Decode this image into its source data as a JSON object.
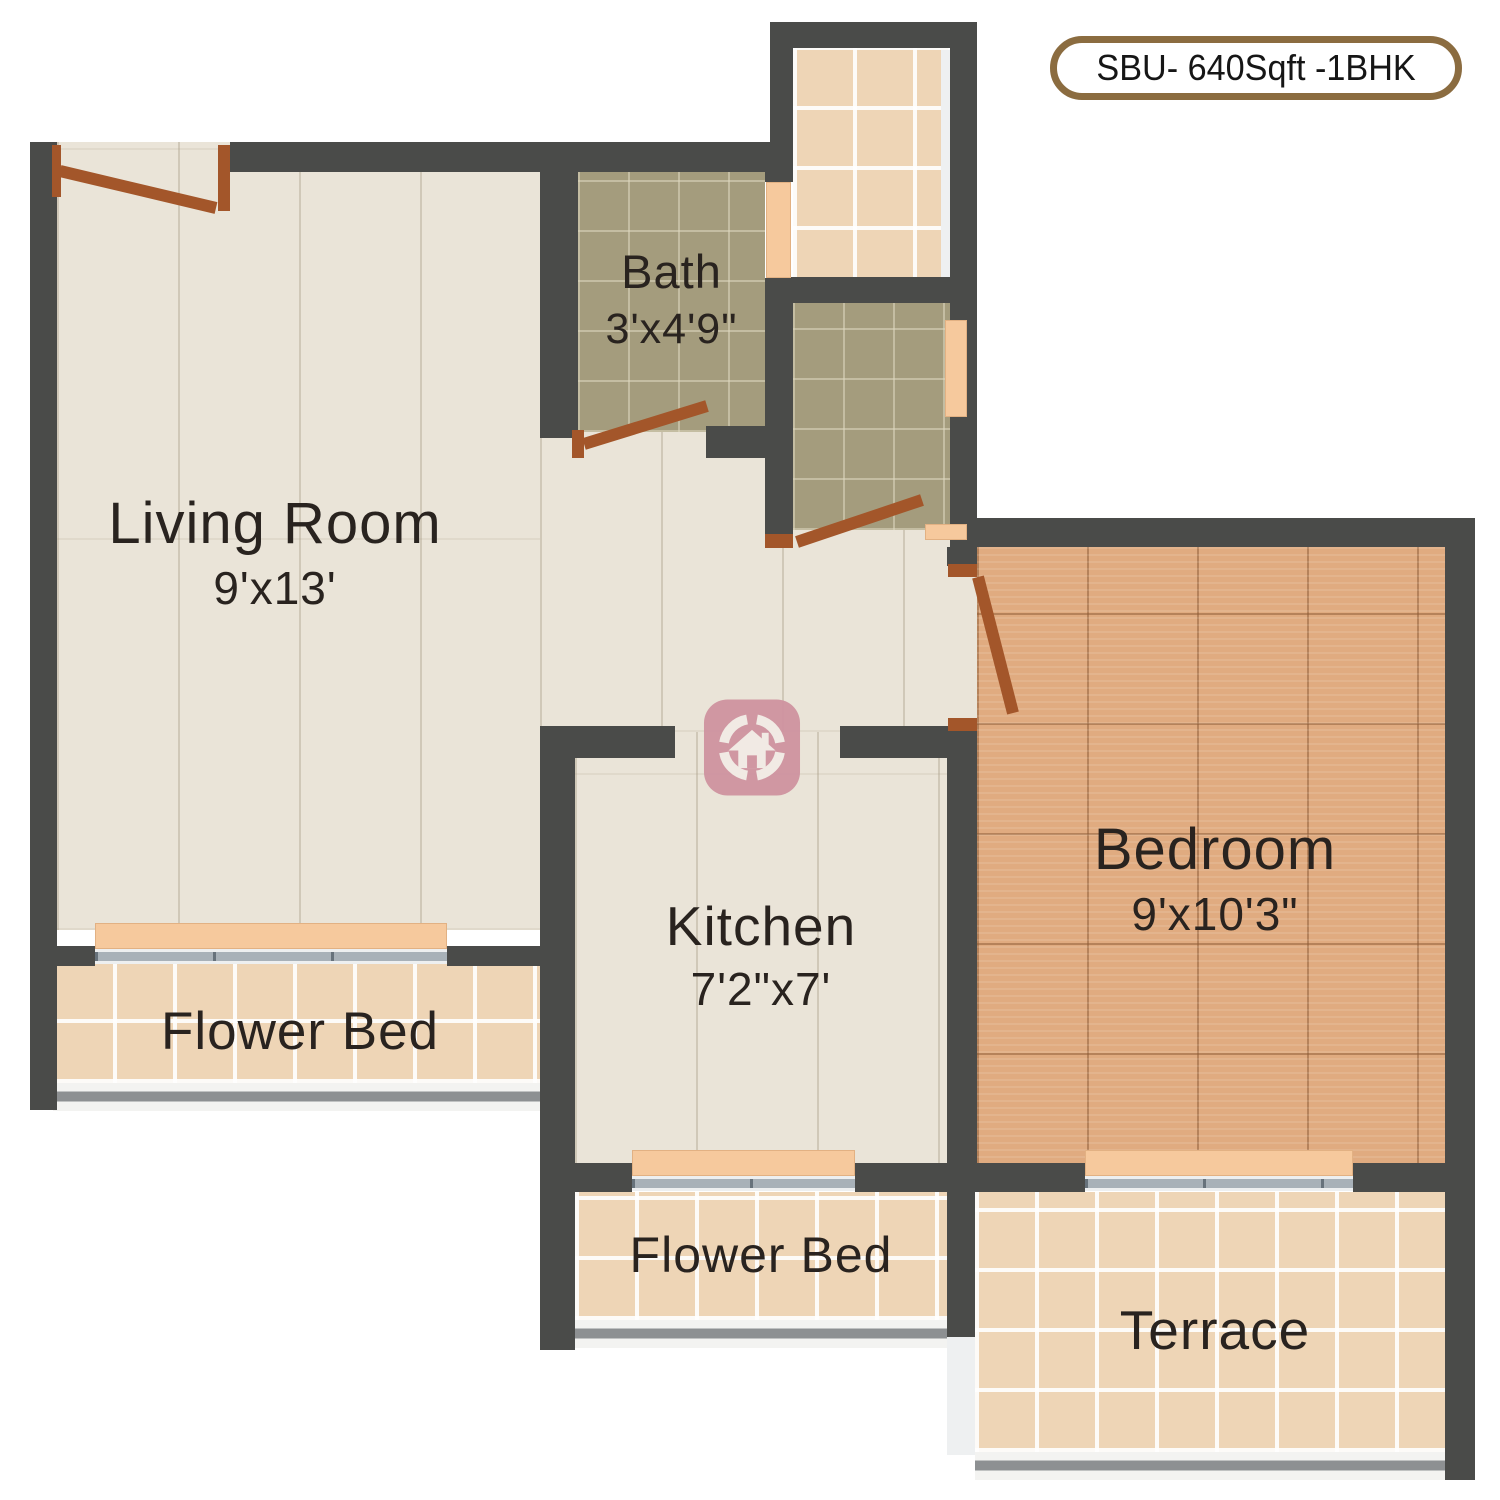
{
  "badge": {
    "label": "SBU- 640Sqft -1BHK"
  },
  "rooms": {
    "living": {
      "name": "Living Room",
      "dims": "9'x13'"
    },
    "bath": {
      "name": "Bath",
      "dims": "3'x4'9\""
    },
    "kitchen": {
      "name": "Kitchen",
      "dims": "7'2\"x7'"
    },
    "bedroom": {
      "name": "Bedroom",
      "dims": "9'x10'3\""
    },
    "flower_bed_1": {
      "name": "Flower Bed"
    },
    "flower_bed_2": {
      "name": "Flower Bed"
    },
    "terrace": {
      "name": "Terrace"
    }
  },
  "logo": {
    "name": "house-circle-watermark"
  },
  "colors": {
    "wall": "#4a4b49",
    "floor_cream": "#eae4d8",
    "tile_olive": "#a49c7d",
    "tile_tan": "#eed5b6",
    "floor_wood": "#e0ab80",
    "window_sill_peach": "#f6c99d",
    "door_brown": "#a3562a",
    "glass_gray": "#a8b1b8",
    "logo_pink": "#cf93a0",
    "badge_border": "#8b6c40"
  }
}
